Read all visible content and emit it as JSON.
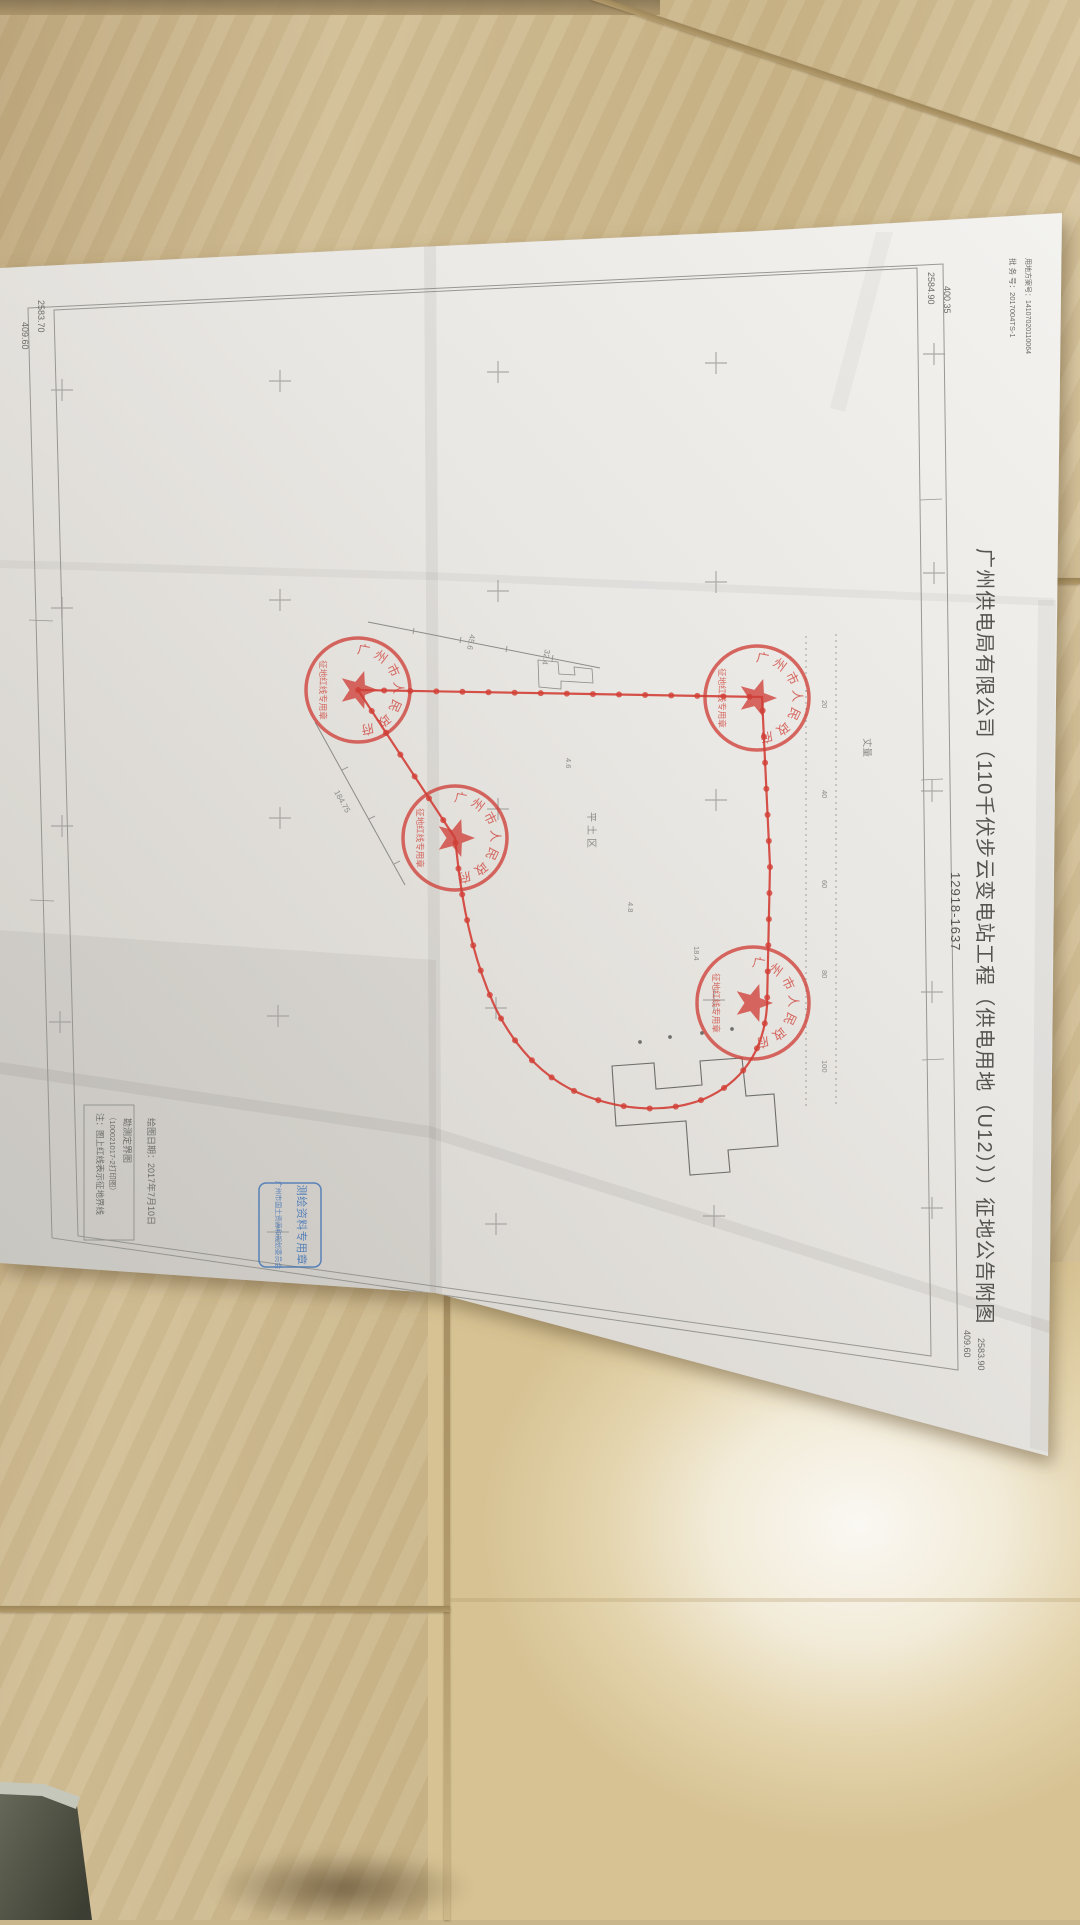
{
  "document": {
    "title": "广州供电局有限公司（110千伏步云变电站工程（供电用地（U12）））征地公告附图",
    "sheet_number": "12918-1637",
    "header_notes": [
      "批 务 号：2017004TS-1",
      "用地方案号：14107020110064"
    ],
    "note_box_lines": [
      "注：图上红线表示征地界线",
      "（100021017-2打印图）",
      "勘测定界图"
    ],
    "drawing_date_note": "绘图日期：2017年7月10日",
    "corner_coordinates": {
      "top_left": [
        "2583.70",
        "409.60"
      ],
      "top_right": [
        "2584.90",
        "400.35"
      ],
      "bottom_right": [
        "409.60",
        "2583.90"
      ]
    },
    "round_seal": {
      "ring_text": "广州市人民政府",
      "banner_text": "征地红线专用章"
    },
    "blue_stamp": {
      "line1": "测绘资料专用章",
      "line2": "广州市国土资源和规划委员会"
    },
    "map_labels": {
      "area_label": "平土区",
      "ruler_label": "丈量",
      "ruler_ticks": [
        "20",
        "40",
        "60",
        "80",
        "100"
      ],
      "dimensions": [
        "45.6",
        "32.4",
        "184.75",
        "4.6",
        "4.8",
        "18.4"
      ]
    },
    "colors": {
      "seal_red": "#cf4038",
      "boundary_red": "#d23f36",
      "stamp_blue": "#3a6fb5",
      "pencil_gray": "#8b8b87"
    }
  }
}
